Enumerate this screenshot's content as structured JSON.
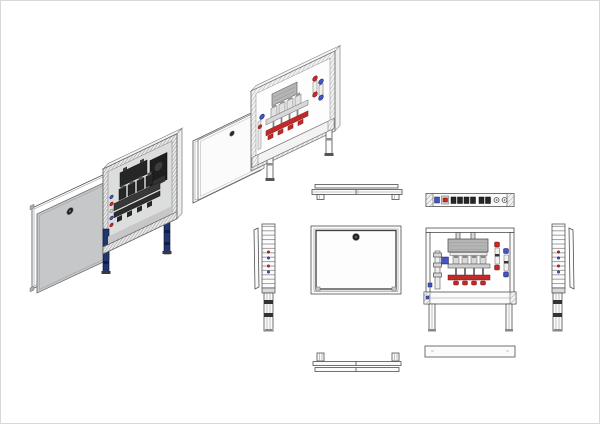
{
  "drawing": {
    "type": "technical-multiview-drawing",
    "subject": "heating-manifold-cabinet",
    "views": [
      "iso-exploded-cabinet-gray-door",
      "iso-exploded-cabinet-white-door",
      "top-view-closed",
      "top-view-manifold",
      "side-view-left",
      "front-view-closed",
      "front-view-open",
      "side-view-right",
      "bottom-view-closed",
      "bottom-view-open"
    ]
  },
  "manifold": {
    "loops": 4,
    "actuator_count": 4,
    "legs_per_cabinet": 2
  },
  "colors": {
    "background": "#ffffff",
    "line": "#4f4f4f",
    "door_gray": "#c5c7c9",
    "door_gray_edge": "#7e8184",
    "panel_white": "#fbfbfb",
    "frame_fill": "#f1f1f1",
    "interior_gray": "#dcdddd",
    "hatch_gray": "#9b9b9b",
    "leg_blue": "#21356f",
    "component_dark": "#262626",
    "component_mid": "#4a4a4a",
    "metal_light": "#d9d9d9",
    "metal_mid": "#b3b3b3",
    "box_gray": "#b5b5b5",
    "supply_red": "#c22a28",
    "return_blue": "#4553c4"
  }
}
